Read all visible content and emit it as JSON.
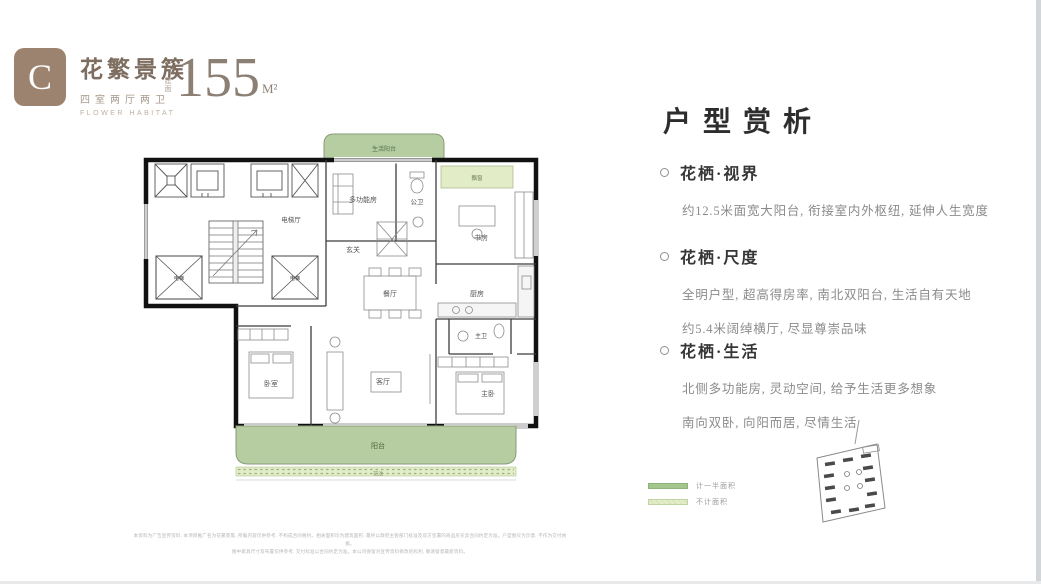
{
  "header": {
    "badge_letter": "C",
    "title": "花繁景簇",
    "subtitle": "四室两厅两卫",
    "subtitle_en": "FLOWER HABITAT",
    "area_prefix": "建面",
    "area_value": "155",
    "area_unit": "M²"
  },
  "analysis": {
    "heading": "户型赏析",
    "sections": [
      {
        "title": "花栖·视界",
        "lines": [
          "约12.5米面宽大阳台, 衔接室内外枢纽, 延伸人生宽度"
        ]
      },
      {
        "title": "花栖·尺度",
        "lines": [
          "全明户型, 超高得房率, 南北双阳台, 生活自有天地",
          "约5.4米阔绰横厅, 尽显尊崇品味"
        ]
      },
      {
        "title": "花栖·生活",
        "lines": [
          "北侧多功能房, 灵动空间, 给予生活更多想象",
          "南向双卧, 向阳而居, 尽情生活"
        ]
      }
    ]
  },
  "floorplan": {
    "labels": {
      "shenghuo_yangtai": "生活阳台",
      "piaochuang": "飘窗",
      "dianting": "电梯厅",
      "dianti_left": "电梯",
      "dianti_right": "电梯",
      "duogongnengfang": "多功能房",
      "gongwei": "公卫",
      "xuanguan": "玄关",
      "shufang": "书房",
      "chufang": "厨房",
      "canting": "餐厅",
      "zhuwei": "主卫",
      "zhuwo": "主卧",
      "keting": "客厅",
      "woshi": "卧室",
      "yangtai": "阳台",
      "huachi": "花池"
    }
  },
  "legend": {
    "items": [
      {
        "label": "计一半面积",
        "color": "#a3c78d"
      },
      {
        "label": "不计面积",
        "color": "#e4edc9"
      }
    ]
  },
  "disclaimer": {
    "line1": "本资料为广告宣传资料, 本项目推广名为花繁景簇, 所载内容仅供参考, 不构成合同要约。相关面积均为建筑面积, 最终以政府主管部门核准及双方签署的商品房买卖合同约定为准。户型图仅为示意, 不作为交付依据。",
    "line2": "图中家具尺寸及布置仅供参考, 交付标准以合同约定为准。本公司保留对宣传资料修改的权利, 敬请留意最新资料。"
  },
  "colors": {
    "brand_brown": "#9c8370",
    "title_brown": "#7e6e60",
    "heading_dark": "#2d2d2d",
    "body_gray": "#8b8b8b",
    "balcony_green": "#b5cda0",
    "light_green": "#e2ecc6",
    "wall_black": "#111111"
  }
}
